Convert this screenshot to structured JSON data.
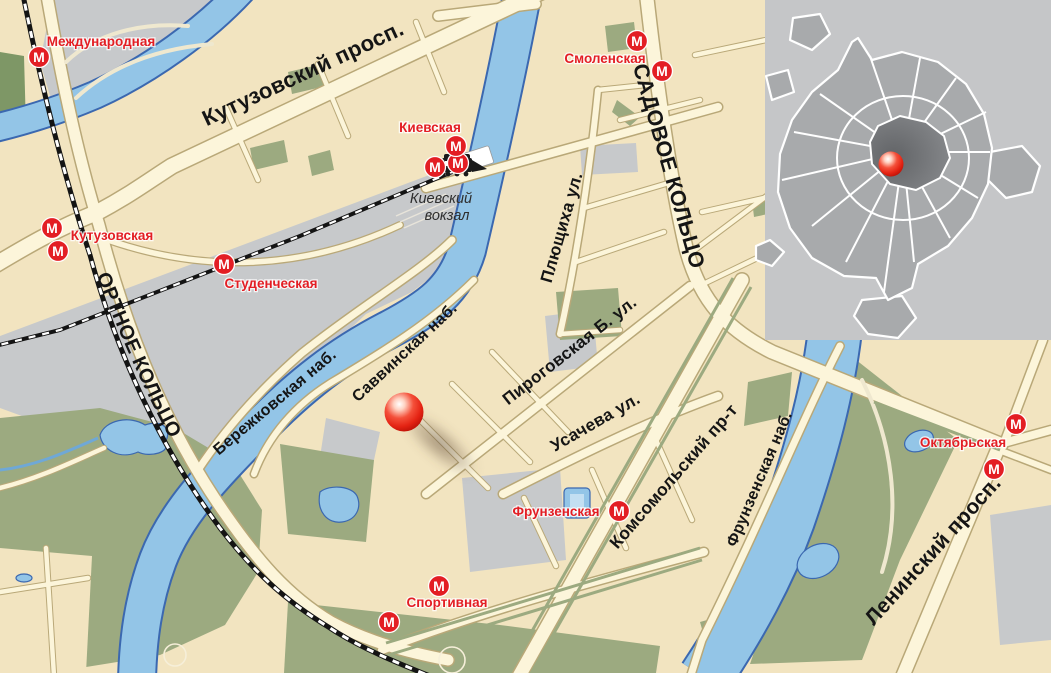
{
  "map": {
    "kind": "city street map with metro stations and location marker",
    "city_overview_inset": "Moscow city silhouette with ring roads and location dot"
  },
  "colors": {
    "metro_red": "#E31E24",
    "station_label_red": "#E31E24",
    "street_label_black": "#151515",
    "river_blue": "#93C5E7",
    "river_outline_blue": "#3B68B0",
    "park_green": "#9CAA80",
    "block_beige": "#F2E4C0",
    "block_gray": "#C7C9CB",
    "road_cream": "#FCF5DA",
    "marker_red": "#E8291C",
    "railway_black": "#141414",
    "inset_background": "#C5C6C8",
    "inset_city_gray": "#A8AAAC",
    "inset_center_gray": "#7A7C7F"
  },
  "streets": [
    {
      "name": "Кутузовский просп."
    },
    {
      "name": "САДОВОЕ КОЛЬЦО"
    },
    {
      "name": "ТРЕТЬЕ ТРАНСПОРТНОЕ КОЛЬЦО"
    },
    {
      "name": "Плющиха ул."
    },
    {
      "name": "Саввинская наб."
    },
    {
      "name": "Бережковская наб."
    },
    {
      "name": "Пироговская Б. ул."
    },
    {
      "name": "Усачева ул."
    },
    {
      "name": "Комсомольский пр-т"
    },
    {
      "name": "Фрунзенская наб."
    },
    {
      "name": "Ленинский просп."
    }
  ],
  "stations": [
    {
      "name": "Международная"
    },
    {
      "name": "Кутузовская"
    },
    {
      "name": "Студенческая"
    },
    {
      "name": "Киевская"
    },
    {
      "name": "Смоленская"
    },
    {
      "name": "Фрунзенская"
    },
    {
      "name": "Спортивная"
    },
    {
      "name": "Октябрьская"
    }
  ],
  "landmark": {
    "line1": "Киевский",
    "line2": "вокзал"
  },
  "metro": {
    "logo_letter": "М"
  }
}
